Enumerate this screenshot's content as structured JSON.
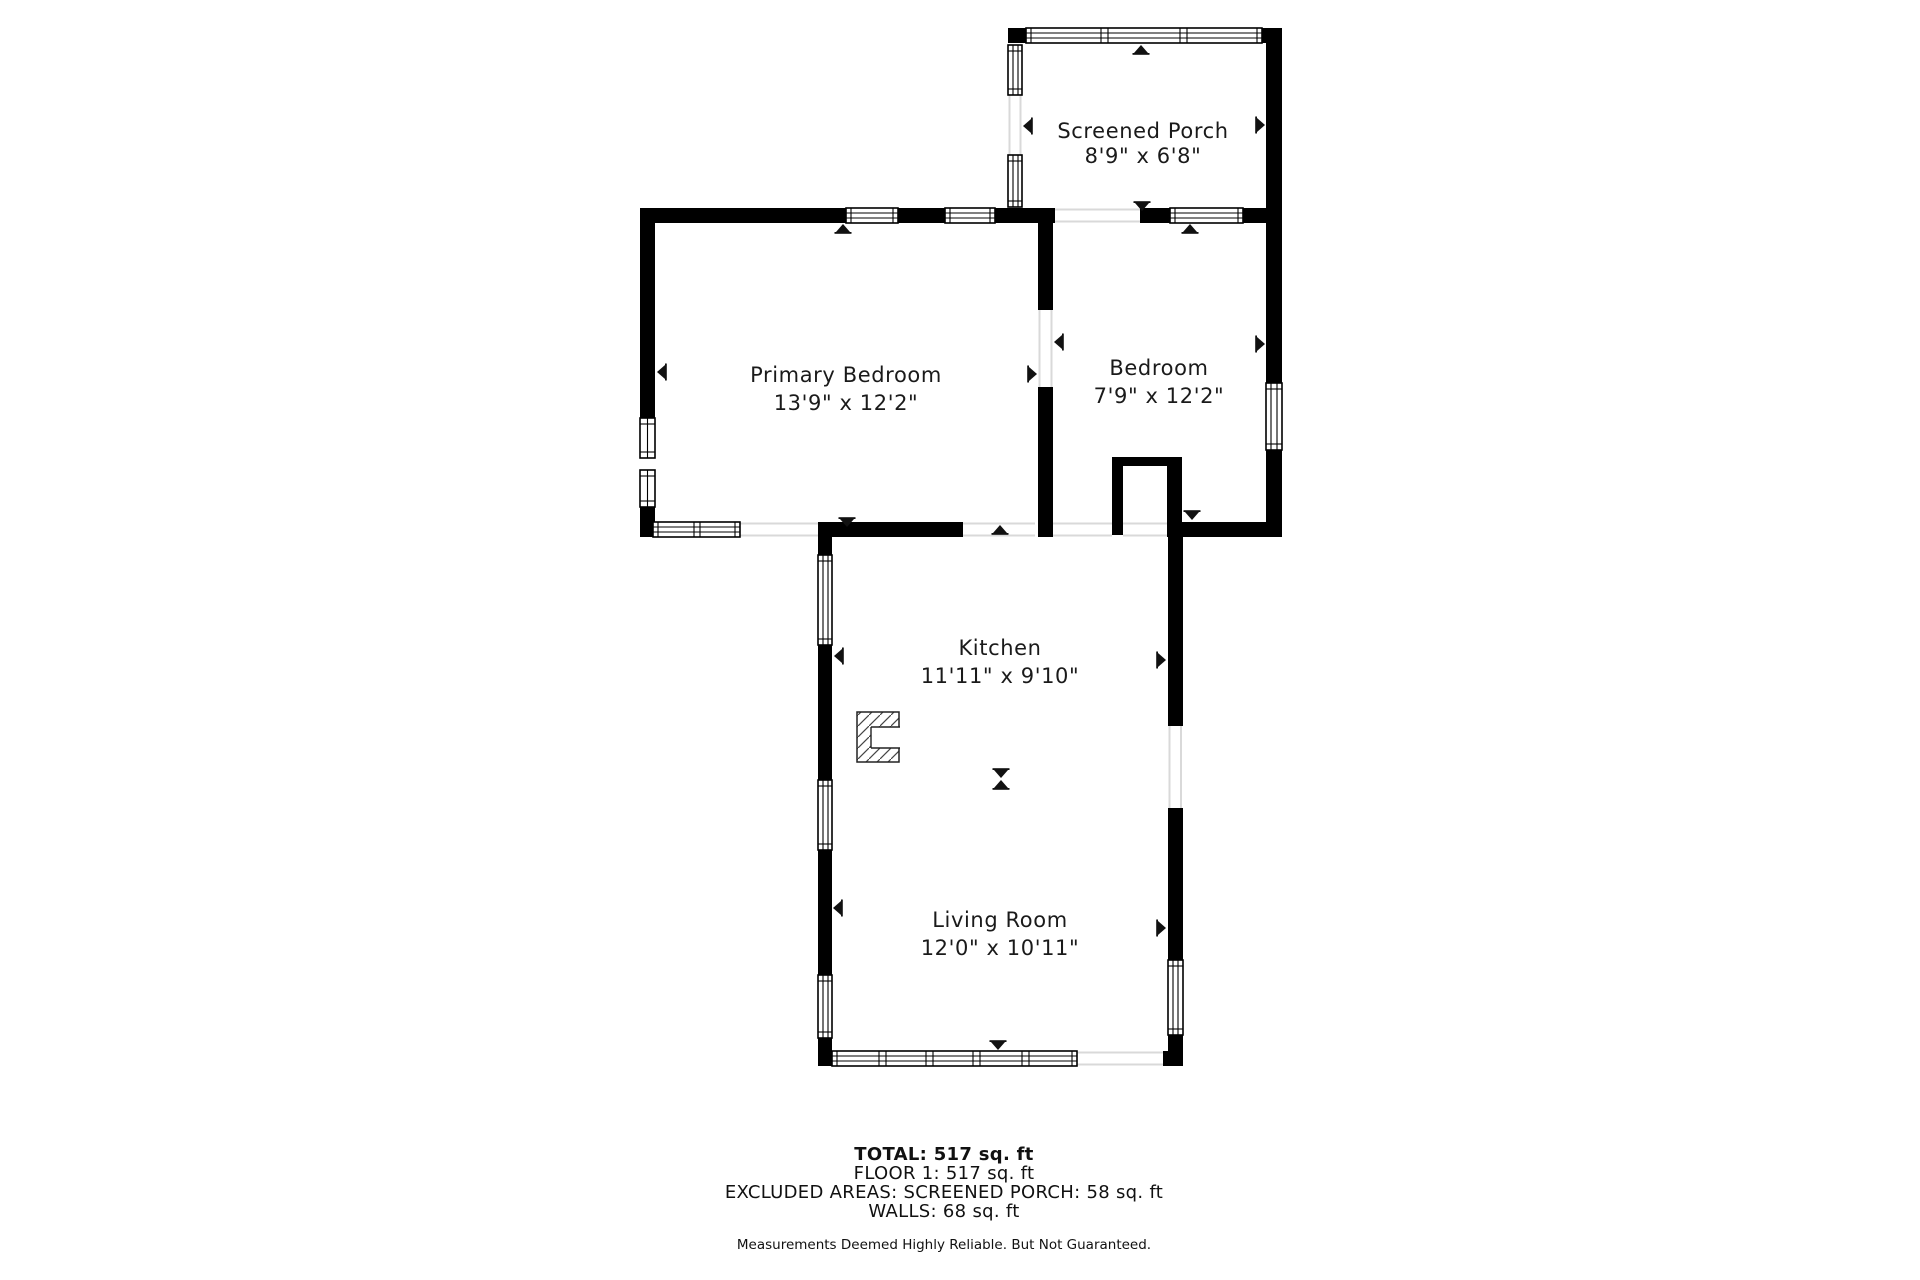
{
  "rooms": [
    {
      "name": "Screened Porch",
      "dims": "8'9\" x 6'8\""
    },
    {
      "name": "Primary Bedroom",
      "dims": "13'9\" x 12'2\""
    },
    {
      "name": "Bedroom",
      "dims": "7'9\" x 12'2\""
    },
    {
      "name": "Kitchen",
      "dims": "11'11\" x 9'10\""
    },
    {
      "name": "Living Room",
      "dims": "12'0\" x 10'11\""
    }
  ],
  "footer": {
    "total": "TOTAL: 517 sq. ft",
    "floor": "FLOOR 1: 517 sq. ft",
    "excluded": "EXCLUDED AREAS: SCREENED PORCH: 58 sq. ft",
    "walls": "WALLS: 68 sq. ft",
    "disclaimer": "Measurements Deemed Highly Reliable. But Not Guaranteed."
  },
  "colors": {
    "wall": "#000000",
    "background": "#ffffff",
    "opening": "#d9d9d9",
    "text": "#1a1a1a"
  }
}
